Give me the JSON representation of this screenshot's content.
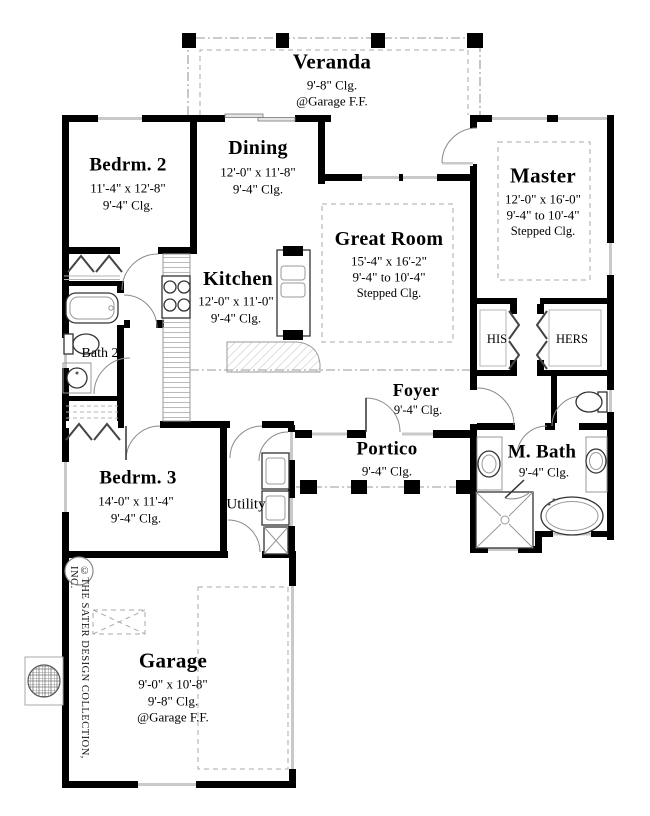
{
  "plan_title": "Floor Plan",
  "rooms": {
    "veranda": {
      "name": "Veranda",
      "clg": "9'-8\" Clg.",
      "note": "@Garage F.F."
    },
    "bedrm2": {
      "name": "Bedrm. 2",
      "dims": "11'-4\" x 12'-8\"",
      "clg": "9'-4\" Clg."
    },
    "dining": {
      "name": "Dining",
      "dims": "12'-0\" x 11'-8\"",
      "clg": "9'-4\" Clg."
    },
    "master": {
      "name": "Master",
      "dims": "12'-0\" x 16'-0\"",
      "range": "9'-4\" to 10'-4\"",
      "stepped": "Stepped Clg."
    },
    "great_room": {
      "name": "Great Room",
      "dims": "15'-4\" x 16'-2\"",
      "range": "9'-4\" to 10'-4\"",
      "stepped": "Stepped Clg."
    },
    "kitchen": {
      "name": "Kitchen",
      "dims": "12'-0\" x 11'-0\"",
      "clg": "9'-4\" Clg."
    },
    "bath2": {
      "name": "Bath 2"
    },
    "his": {
      "name": "HIS"
    },
    "hers": {
      "name": "HERS"
    },
    "foyer": {
      "name": "Foyer",
      "clg": "9'-4\" Clg."
    },
    "portico": {
      "name": "Portico",
      "clg": "9'-4\" Clg."
    },
    "mbath": {
      "name": "M. Bath",
      "clg": "9'-4\" Clg."
    },
    "bedrm3": {
      "name": "Bedrm. 3",
      "dims": "14'-0\" x 11'-4\"",
      "clg": "9'-4\" Clg."
    },
    "utility": {
      "name": "Utility"
    },
    "garage": {
      "name": "Garage",
      "dims": "9'-0\" x 10'-8\"",
      "clg": "9'-8\" Clg.",
      "note": "@Garage F.F."
    }
  },
  "copyright": "©THE SATER DESIGN COLLECTION, INC.",
  "colors": {
    "wall": "#000000",
    "window": "#c9c9c9",
    "dash": "#999999",
    "paper": "#ffffff"
  }
}
